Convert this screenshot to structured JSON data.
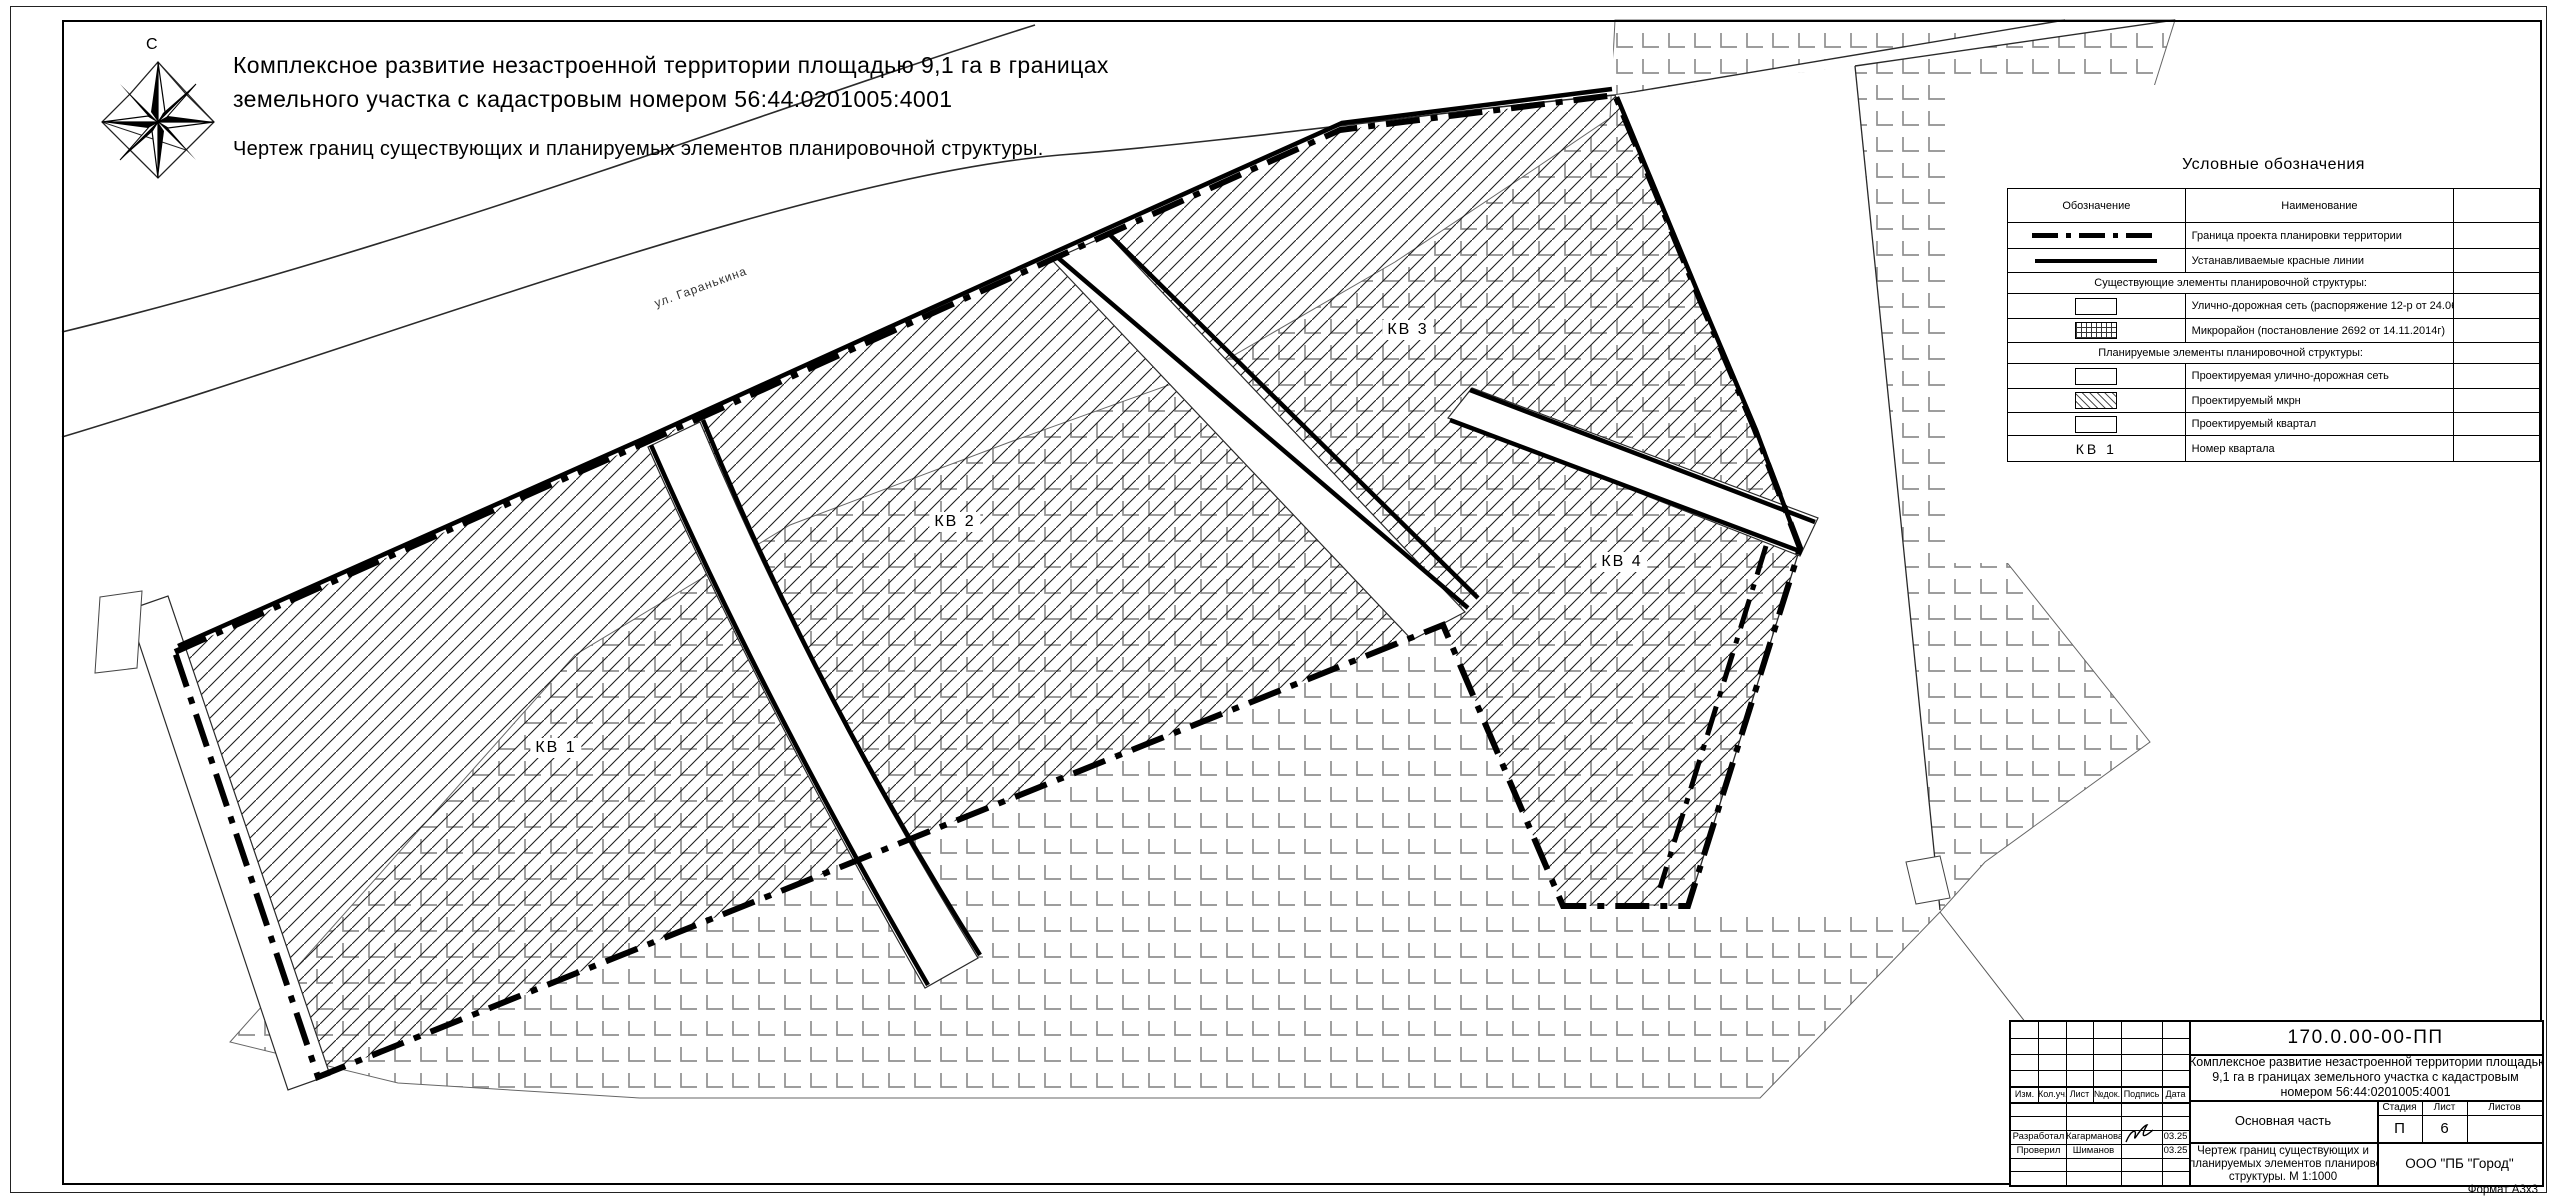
{
  "drawing": {
    "north_label": "С",
    "title_line1": "Комплексное развитие незастроенной территории площадью 9,1 га в границах",
    "title_line2": "земельного участка с кадастровым номером 56:44:0201005:4001",
    "subtitle": "Чертеж границ существующих и планируемых элементов планировочной структуры.",
    "street_label": "ул. Гаранькина",
    "quarters": {
      "kv1": "КВ 1",
      "kv2": "КВ 2",
      "kv3": "КВ 3",
      "kv4": "КВ 4"
    },
    "format_label": "Формат А3х3"
  },
  "legend": {
    "title": "Условные обозначения",
    "header": {
      "symbol": "Обозначение",
      "name": "Наименование"
    },
    "rows": [
      {
        "symbol": "project-boundary-dashed-line",
        "name": "Граница проекта планировки территории"
      },
      {
        "symbol": "red-line-solid",
        "name": "Устанавливаемые красные линии"
      },
      {
        "symbol": "section",
        "name": "Существующие элементы планировочной структуры:"
      },
      {
        "symbol": "existing-road-rect",
        "name": "Улично-дорожная сеть (распоряжение 12-р от 24.06.24г)"
      },
      {
        "symbol": "microdistrict-grid-rect",
        "name": "Микрорайон (постановление 2692 от 14.11.2014г)"
      },
      {
        "symbol": "section",
        "name": "Планируемые элементы планировочной структуры:"
      },
      {
        "symbol": "planned-road-rect",
        "name": "Проектируемая улично-дорожная сеть"
      },
      {
        "symbol": "planned-mkrn-hatch-rect",
        "name": "Проектируемый мкрн"
      },
      {
        "symbol": "planned-quarter-rect",
        "name": "Проектируемый квартал"
      },
      {
        "symbol": "quarter-number-text",
        "symbol_text": "КВ 1",
        "name": "Номер квартала"
      }
    ]
  },
  "title_block": {
    "doc_number": "170.0.00-00-ПП",
    "project_line1": "Комплексное развитие незастроенной территории площадью",
    "project_line2": "9,1 га в границах земельного участка с кадастровым",
    "project_line3": "номером 56:44:0201005:4001",
    "cols": {
      "izm": "Изм.",
      "koluch": "Кол.уч.",
      "list": "Лист",
      "ndok": "№док.",
      "podpis": "Подпись",
      "data": "Дата"
    },
    "developed_label": "Разработал",
    "developed_name": "Кагарманова",
    "developed_date": "03.25",
    "checked_label": "Проверил",
    "checked_name": "Шиманов",
    "checked_date": "03.25",
    "section_name": "Основная часть",
    "stage_label": "Стадия",
    "list_label": "Лист",
    "listov_label": "Листов",
    "stage_value": "П",
    "list_value": "6",
    "listov_value": "",
    "drawing_name_line1": "Чертеж границ существующих и",
    "drawing_name_line2": "планируемых элементов планировочной",
    "drawing_name_line3": "структуры. М 1:1000",
    "company": "ООО \"ПБ \"Город\""
  }
}
